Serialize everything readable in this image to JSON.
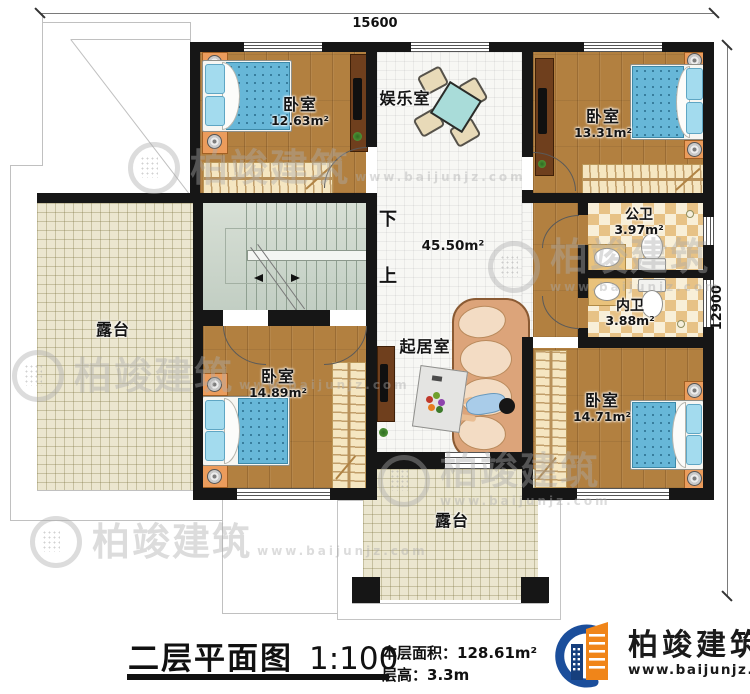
{
  "dimensions": {
    "width_label": "15600",
    "height_label": "12900"
  },
  "stairs": {
    "down_label": "下",
    "up_label": "上"
  },
  "hall": {
    "area": "45.50m²"
  },
  "rooms": {
    "bedroom_top_left": {
      "name": "卧室",
      "area": "12.63m²"
    },
    "bedroom_top_right": {
      "name": "卧室",
      "area": "13.31m²"
    },
    "bedroom_bottom_left": {
      "name": "卧室",
      "area": "14.89m²"
    },
    "bedroom_bottom_right": {
      "name": "卧室",
      "area": "14.71m²"
    },
    "entertainment_room": {
      "name": "娱乐室"
    },
    "living_room": {
      "name": "起居室"
    },
    "public_bathroom": {
      "name": "公卫",
      "area": "3.97m²"
    },
    "private_bathroom": {
      "name": "内卫",
      "area": "3.88m²"
    },
    "terrace_left": {
      "name": "露台"
    },
    "terrace_bottom": {
      "name": "露台"
    }
  },
  "footer": {
    "title": "二层平面图",
    "scale": "1:100",
    "floor_area_label": "本层面积：",
    "floor_area_value": "128.61m²",
    "floor_height_label": "层高：",
    "floor_height_value": "3.3m"
  },
  "brand": {
    "name": "柏竣建筑",
    "website": "www.baijunjz.com"
  },
  "watermark": {
    "name": "柏竣建筑",
    "website": "www.baijunjz.com"
  },
  "colors": {
    "wall": "#161616",
    "wood_floor": "#b28040",
    "tile_floor": "#f7f7f4",
    "terrace_floor": "#ebe6cf",
    "stair_floor": "#ccd6cb",
    "bath_tile": "#e7c286",
    "mattress": "#67b7d8",
    "brand_blue": "#1b4e9b",
    "brand_orange": "#f08519"
  }
}
